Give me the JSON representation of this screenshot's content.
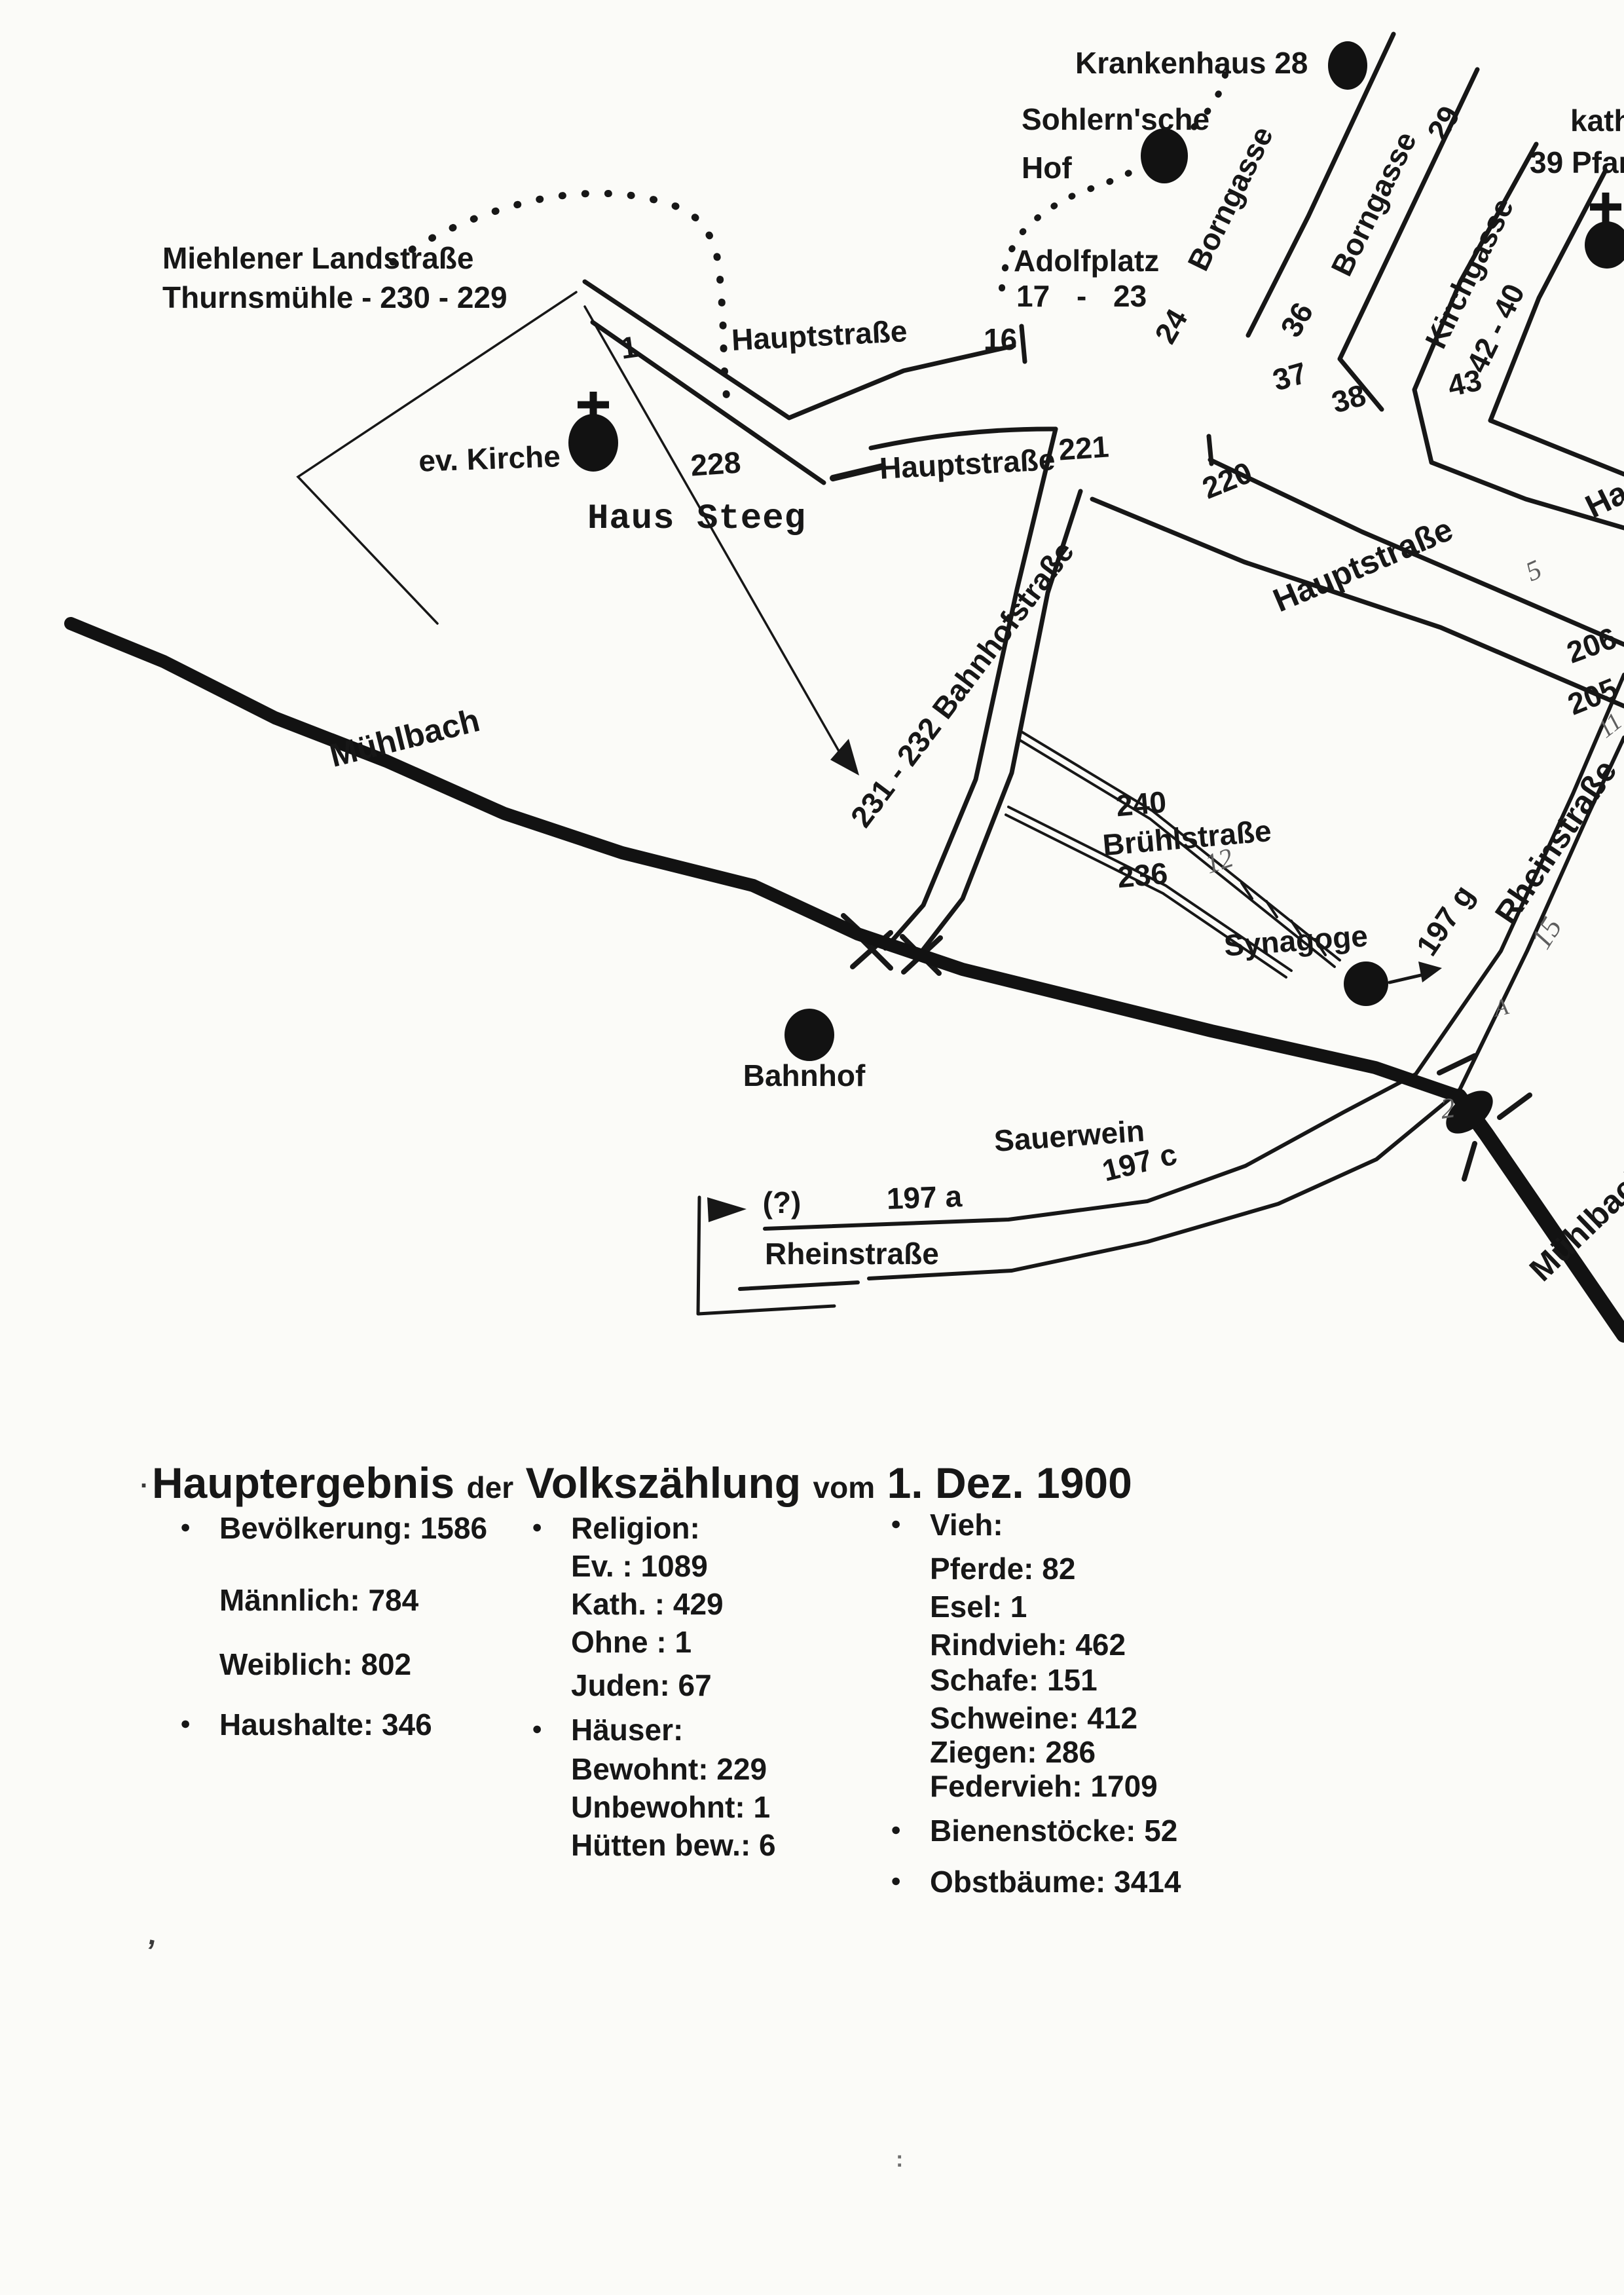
{
  "page": {
    "background": "#fbfbf8",
    "ink": "#171717",
    "pencil": "#5e5e5e",
    "description_symbols": {
      "filled-dot": "building landmark",
      "latin-cross": "church",
      "arrowhead": "direction pointer"
    }
  },
  "map": {
    "labels": {
      "krankenhaus": "Krankenhaus 28",
      "sohlern_line1": "Sohlern'sche",
      "sohlern_line2": "Hof",
      "borngasse_west": "Borngasse",
      "borngasse_east": "Borngasse",
      "no_29": "29",
      "no_36": "36",
      "no_37": "37",
      "no_38": "38",
      "no_24": "24",
      "kirchgasse": "Kirchgasse",
      "no_42_40": "42 - 40",
      "no_43": "43",
      "kath_clipped": "kath",
      "pfarrhaus_clipped": "39 Pfarr",
      "adolfplatz": "Adolfplatz",
      "adolfplatz_numbers": "17 - 23",
      "miehlener": "Miehlener Landstraße",
      "thurnsmuehle": "Thurnsmühle - 230 - 229",
      "no_1": "1",
      "hauptstrasse_nw": "Hauptstraße",
      "no_16": "16",
      "ev_kirche": "ev. Kirche",
      "no_228": "228",
      "haus_steeg": "Haus Steeg",
      "hauptstrasse_mid": "Hauptstraße",
      "no_221": "221",
      "no_220": "220",
      "hauptstrasse_se": "Hauptstraße",
      "hauptstrasse_ne_clipped": "Hau",
      "no_206": "206",
      "no_205": "205",
      "rheinstrasse_ne": "Rheinstraße",
      "bahnhofstrasse": "231 - 232 Bahnhofstraße",
      "no_240": "240",
      "bruehlstrasse": "Brühlstraße",
      "no_236": "236",
      "muehlbach_upper": "Mühlbach",
      "synagoge": "Synagoge",
      "no_197g": "197 g",
      "bahnhof": "Bahnhof",
      "sauerwein": "Sauerwein",
      "no_197c": "197 c",
      "no_197a": "197 a",
      "unknown_mark": "(?)",
      "rheinstrasse_s": "Rheinstraße",
      "muehlbach_lower_clipped": "Mühlbach"
    },
    "handwritten": {
      "h5": "5",
      "h11": "11",
      "h15": "15",
      "hA": "A",
      "h2": "2",
      "h12": "12"
    }
  },
  "census": {
    "title": {
      "part1": "Hauptergebnis",
      "part2": "der",
      "part3": "Volkszählung",
      "part4": "vom",
      "part5": "1. Dez. 1900"
    },
    "bullet_glyph": "●",
    "col1": [
      {
        "text": "Bevölkerung: 1586",
        "bullet": true
      },
      {
        "text": "Männlich: 784",
        "bullet": false
      },
      {
        "text": "Weiblich: 802",
        "bullet": false
      },
      {
        "text": "Haushalte: 346",
        "bullet": true
      }
    ],
    "col2": [
      {
        "text": "Religion:",
        "bullet": true
      },
      {
        "text": "Ev. : 1089",
        "bullet": false
      },
      {
        "text": "Kath. : 429",
        "bullet": false
      },
      {
        "text": "Ohne : 1",
        "bullet": false
      },
      {
        "text": "Juden: 67",
        "bullet": false
      },
      {
        "text": "Häuser:",
        "bullet": true
      },
      {
        "text": "Bewohnt: 229",
        "bullet": false
      },
      {
        "text": "Unbewohnt: 1",
        "bullet": false
      },
      {
        "text": "Hütten bew.: 6",
        "bullet": false
      }
    ],
    "col3": [
      {
        "text": "Vieh:",
        "bullet": true
      },
      {
        "text": "Pferde: 82",
        "bullet": false
      },
      {
        "text": "Esel: 1",
        "bullet": false
      },
      {
        "text": "Rindvieh: 462",
        "bullet": false
      },
      {
        "text": "Schafe: 151",
        "bullet": false
      },
      {
        "text": "Schweine: 412",
        "bullet": false
      },
      {
        "text": "Ziegen: 286",
        "bullet": false
      },
      {
        "text": "Federvieh: 1709",
        "bullet": false
      },
      {
        "text": "Bienenstöcke: 52",
        "bullet": true
      },
      {
        "text": "Obstbäume: 3414",
        "bullet": true
      }
    ],
    "stray": [
      {
        "text": "."
      },
      {
        "text": ","
      },
      {
        "text": ":"
      }
    ]
  }
}
